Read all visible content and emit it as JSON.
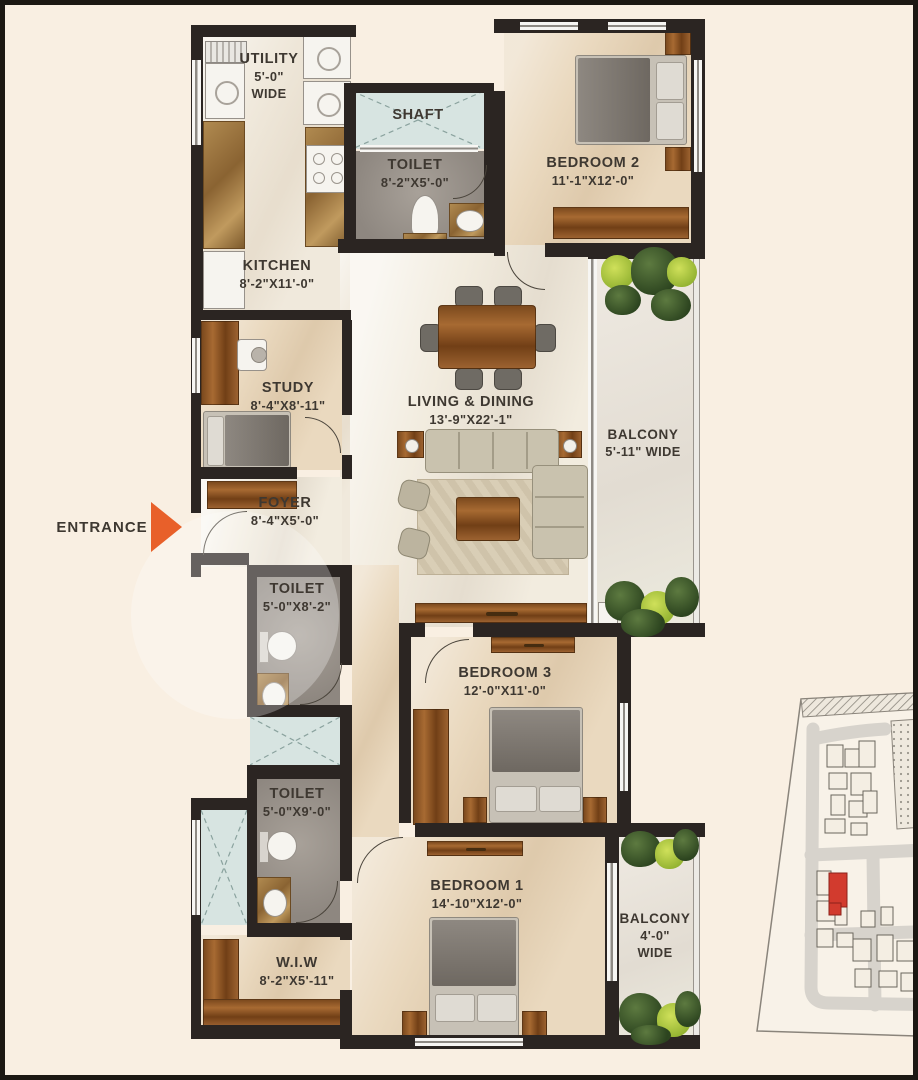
{
  "rooms": {
    "utility": {
      "name": "UTILITY",
      "dim": "5'-0\"",
      "dim2": "WIDE"
    },
    "shaft": {
      "name": "SHAFT"
    },
    "toilet_top": {
      "name": "TOILET",
      "dim": "8'-2\"X5'-0\""
    },
    "bedroom2": {
      "name": "BEDROOM 2",
      "dim": "11'-1\"X12'-0\""
    },
    "kitchen": {
      "name": "KITCHEN",
      "dim": "8'-2\"X11'-0\""
    },
    "study": {
      "name": "STUDY",
      "dim": "8'-4\"X8'-11\""
    },
    "living_dining": {
      "name": "LIVING & DINING",
      "dim": "13'-9\"X22'-1\""
    },
    "balcony_right": {
      "name": "BALCONY",
      "dim": "5'-11\" WIDE"
    },
    "foyer": {
      "name": "FOYER",
      "dim": "8'-4\"X5'-0\""
    },
    "toilet_mid": {
      "name": "TOILET",
      "dim": "5'-0\"X8'-2\""
    },
    "toilet_bottom": {
      "name": "TOILET",
      "dim": "5'-0\"X9'-0\""
    },
    "bedroom3": {
      "name": "BEDROOM 3",
      "dim": "12'-0\"X11'-0\""
    },
    "bedroom1": {
      "name": "BEDROOM 1",
      "dim": "14'-10\"X12'-0\""
    },
    "wiw": {
      "name": "W.I.W",
      "dim": "8'-2\"X5'-11\""
    },
    "balcony_bottom": {
      "name": "BALCONY",
      "dim": "4'-0\"",
      "dim2": "WIDE"
    }
  },
  "entrance": {
    "label": "ENTRANCE"
  },
  "colors": {
    "background": "#f9efe2",
    "walls": "#2b2522",
    "entrance_arrow": "#e8602a",
    "shaft_fill": "#d7e4e1",
    "toilet_floor": "#958e86",
    "wood": "#9c6230",
    "site_highlight": "#d23b2e",
    "label_text": "#3e3831"
  }
}
